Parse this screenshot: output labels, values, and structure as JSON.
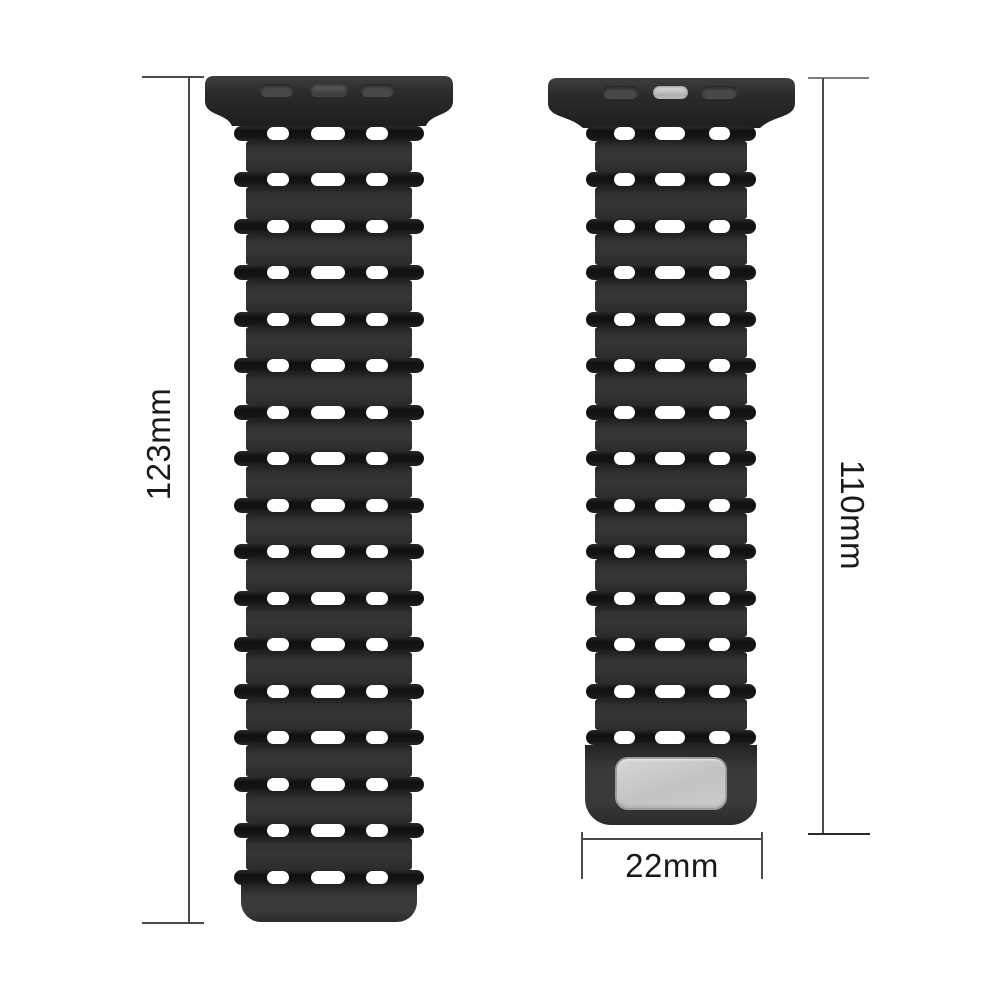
{
  "page": {
    "background": "#ffffff",
    "subject": "watch-strap-dimension-illustration"
  },
  "dimensions": {
    "left_strap_length": "123mm",
    "right_strap_length": "110mm",
    "strap_width": "22mm"
  },
  "straps": {
    "left": {
      "rib_rows": 17,
      "holes_per_row": 3,
      "connector_slots": 3,
      "has_magnet_plate": false
    },
    "right": {
      "rib_rows": 14,
      "holes_per_row": 3,
      "connector_slots": 3,
      "has_magnet_plate": true,
      "accent_slot": "silver"
    }
  },
  "colors": {
    "background": "#ffffff",
    "strap_body": "#323234",
    "rib_dark": "#141416",
    "hole": "#ffffff",
    "magnet_plate_silver": "#c6c6c8",
    "silver_lug_slot": "#c2c2c4",
    "dimension_line": "#4a4a4a",
    "dimension_text": "#1a1a1a"
  }
}
